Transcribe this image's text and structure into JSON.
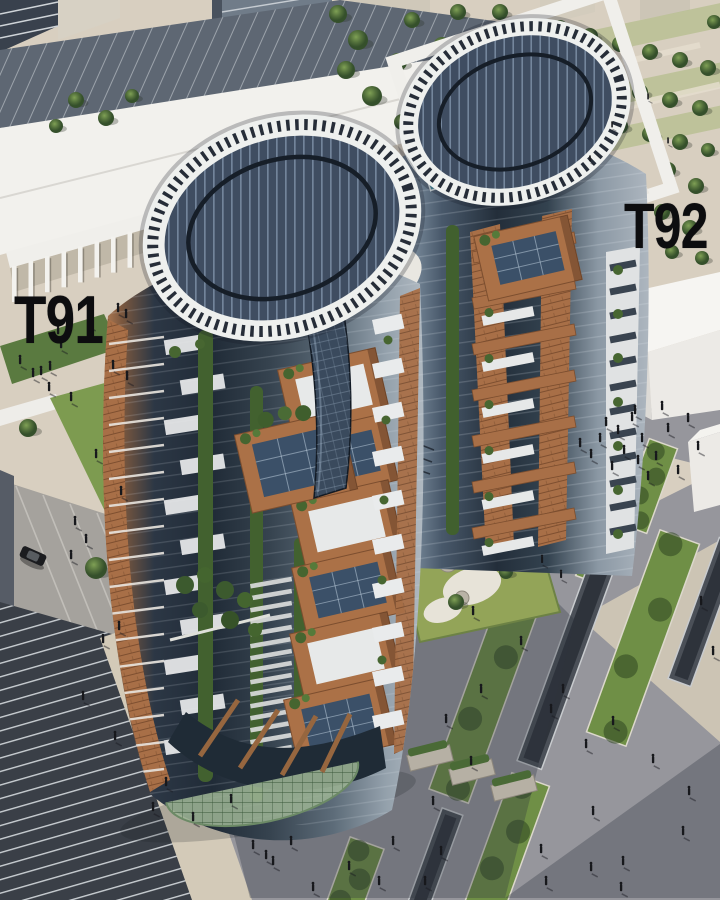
{
  "labels": {
    "tower_left": "T91",
    "tower_right": "T92"
  },
  "palette": {
    "pavement_beige": "#d8cfc0",
    "plaza_grey": "#96969c",
    "solar_panel_navy": "#3f4d61",
    "roof_ring_white": "#eef0ee",
    "slate_roof": "#5e6773",
    "white_building": "#f2f1ed",
    "terracotta_brick": "#ab7147",
    "vine_green": "#42612f",
    "lawn_green": "#7d9b50",
    "tree_green": "#3c5a2e",
    "glass_blue": "#8fa3b3",
    "dark_glass": "#222c38",
    "pool_teal": "#3f8295",
    "shadow_tint": "#343842",
    "label_color": "#0d0d0f"
  }
}
